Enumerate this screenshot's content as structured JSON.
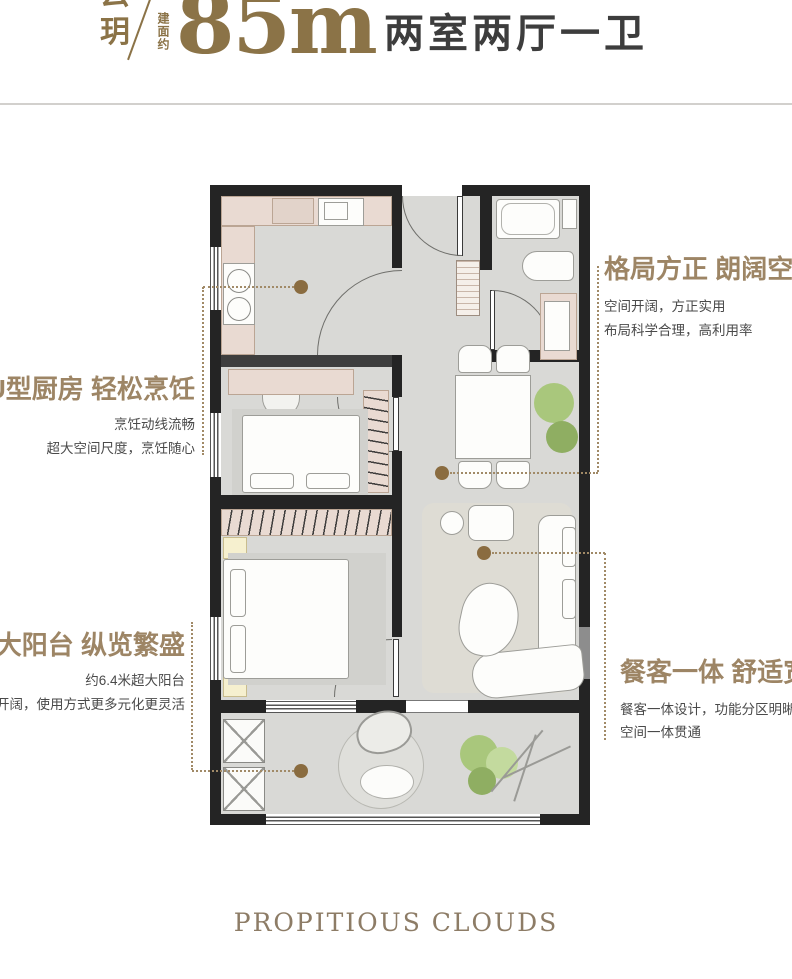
{
  "header": {
    "brand_top": "云",
    "brand_bottom": "玥",
    "area_prefix": "建面约",
    "area_value": "85m",
    "layout_summary": "两室两厅一卫"
  },
  "annotations": {
    "kitchen": {
      "title": "U型厨房 轻松烹饪",
      "line1": "烹饪动线流畅",
      "line2": "超大空间尺度，烹饪随心"
    },
    "structure": {
      "title": "格局方正 朗阔空间",
      "line1": "空间开阔，方正实用",
      "line2": "布局科学合理，高利用率"
    },
    "balcony": {
      "title": "超大阳台 纵览繁盛",
      "line1": "约6.4米超大阳台",
      "line2": "空间开阔，使用方式更多元化更灵活"
    },
    "dining": {
      "title": "餐客一体 舒适宽",
      "line1": "餐客一体设计，功能分区明晰",
      "line2": "空间一体贯通"
    }
  },
  "footer": {
    "brand_en": "PROPITIOUS CLOUDS"
  },
  "colors": {
    "accent": "#97805f",
    "dot": "#8a6c40",
    "text_dark": "#474747",
    "wall": "#242424"
  }
}
